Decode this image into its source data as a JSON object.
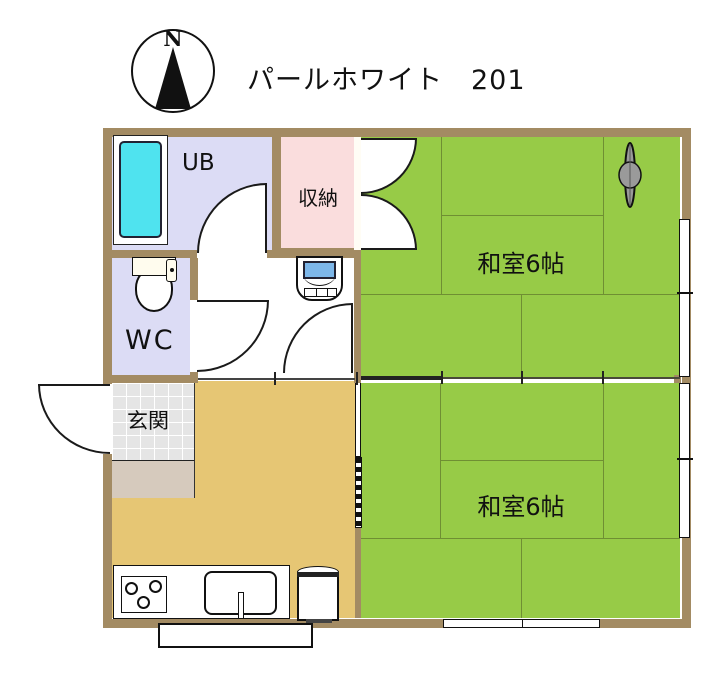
{
  "title": "パールホワイト　201",
  "compass": {
    "label": "N"
  },
  "rooms": {
    "unit_bath": {
      "label": "UB"
    },
    "closet": {
      "label": "収納"
    },
    "toilet": {
      "label": "WC"
    },
    "entrance": {
      "label": "玄関"
    },
    "tatami_room_upper": {
      "label": "和室6帖"
    },
    "tatami_room_lower": {
      "label": "和室6帖"
    }
  },
  "colors": {
    "wall": "#a38b63",
    "tatami": "#97cb47",
    "tatami-line": "#6f8f33",
    "bath-lavender": "#dcdcf5",
    "closet-pink": "#fadddd",
    "kitchen-tan": "#e6c674",
    "tub-cyan": "#4fe3ef",
    "tile-gray": "#e5e5e5",
    "step-beige": "#d6cabd",
    "washer-lid-blue": "#7db7ea",
    "line-dark": "#1a1a1a"
  }
}
